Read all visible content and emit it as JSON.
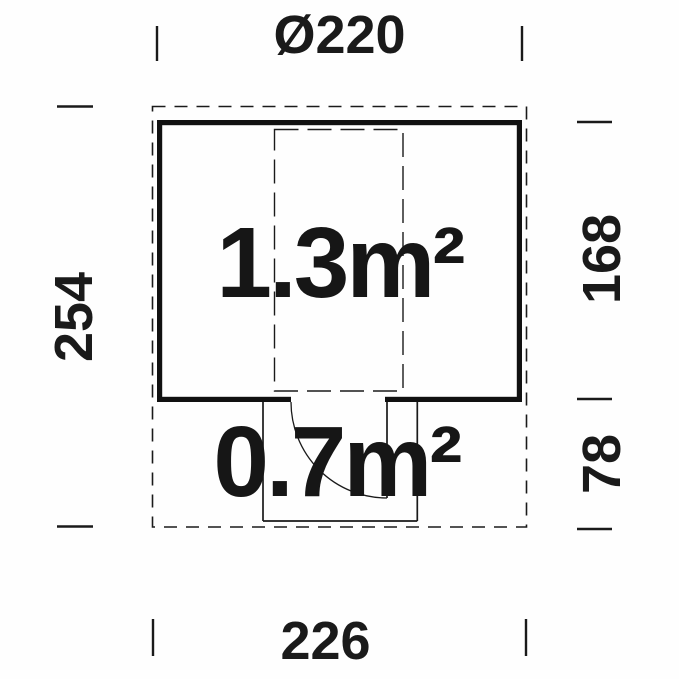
{
  "figure": {
    "type": "floor-plan",
    "areas": {
      "main_room": "1.3m²",
      "annex": "0.7m²"
    },
    "dimensions": {
      "top_width": "Ø220",
      "left_height": "254",
      "right_upper_height": "168",
      "right_lower_height": "78",
      "bottom_width": "226"
    },
    "colors": {
      "line": "#1a1a1a",
      "wall": "#111111",
      "background": "#fefefe"
    }
  }
}
